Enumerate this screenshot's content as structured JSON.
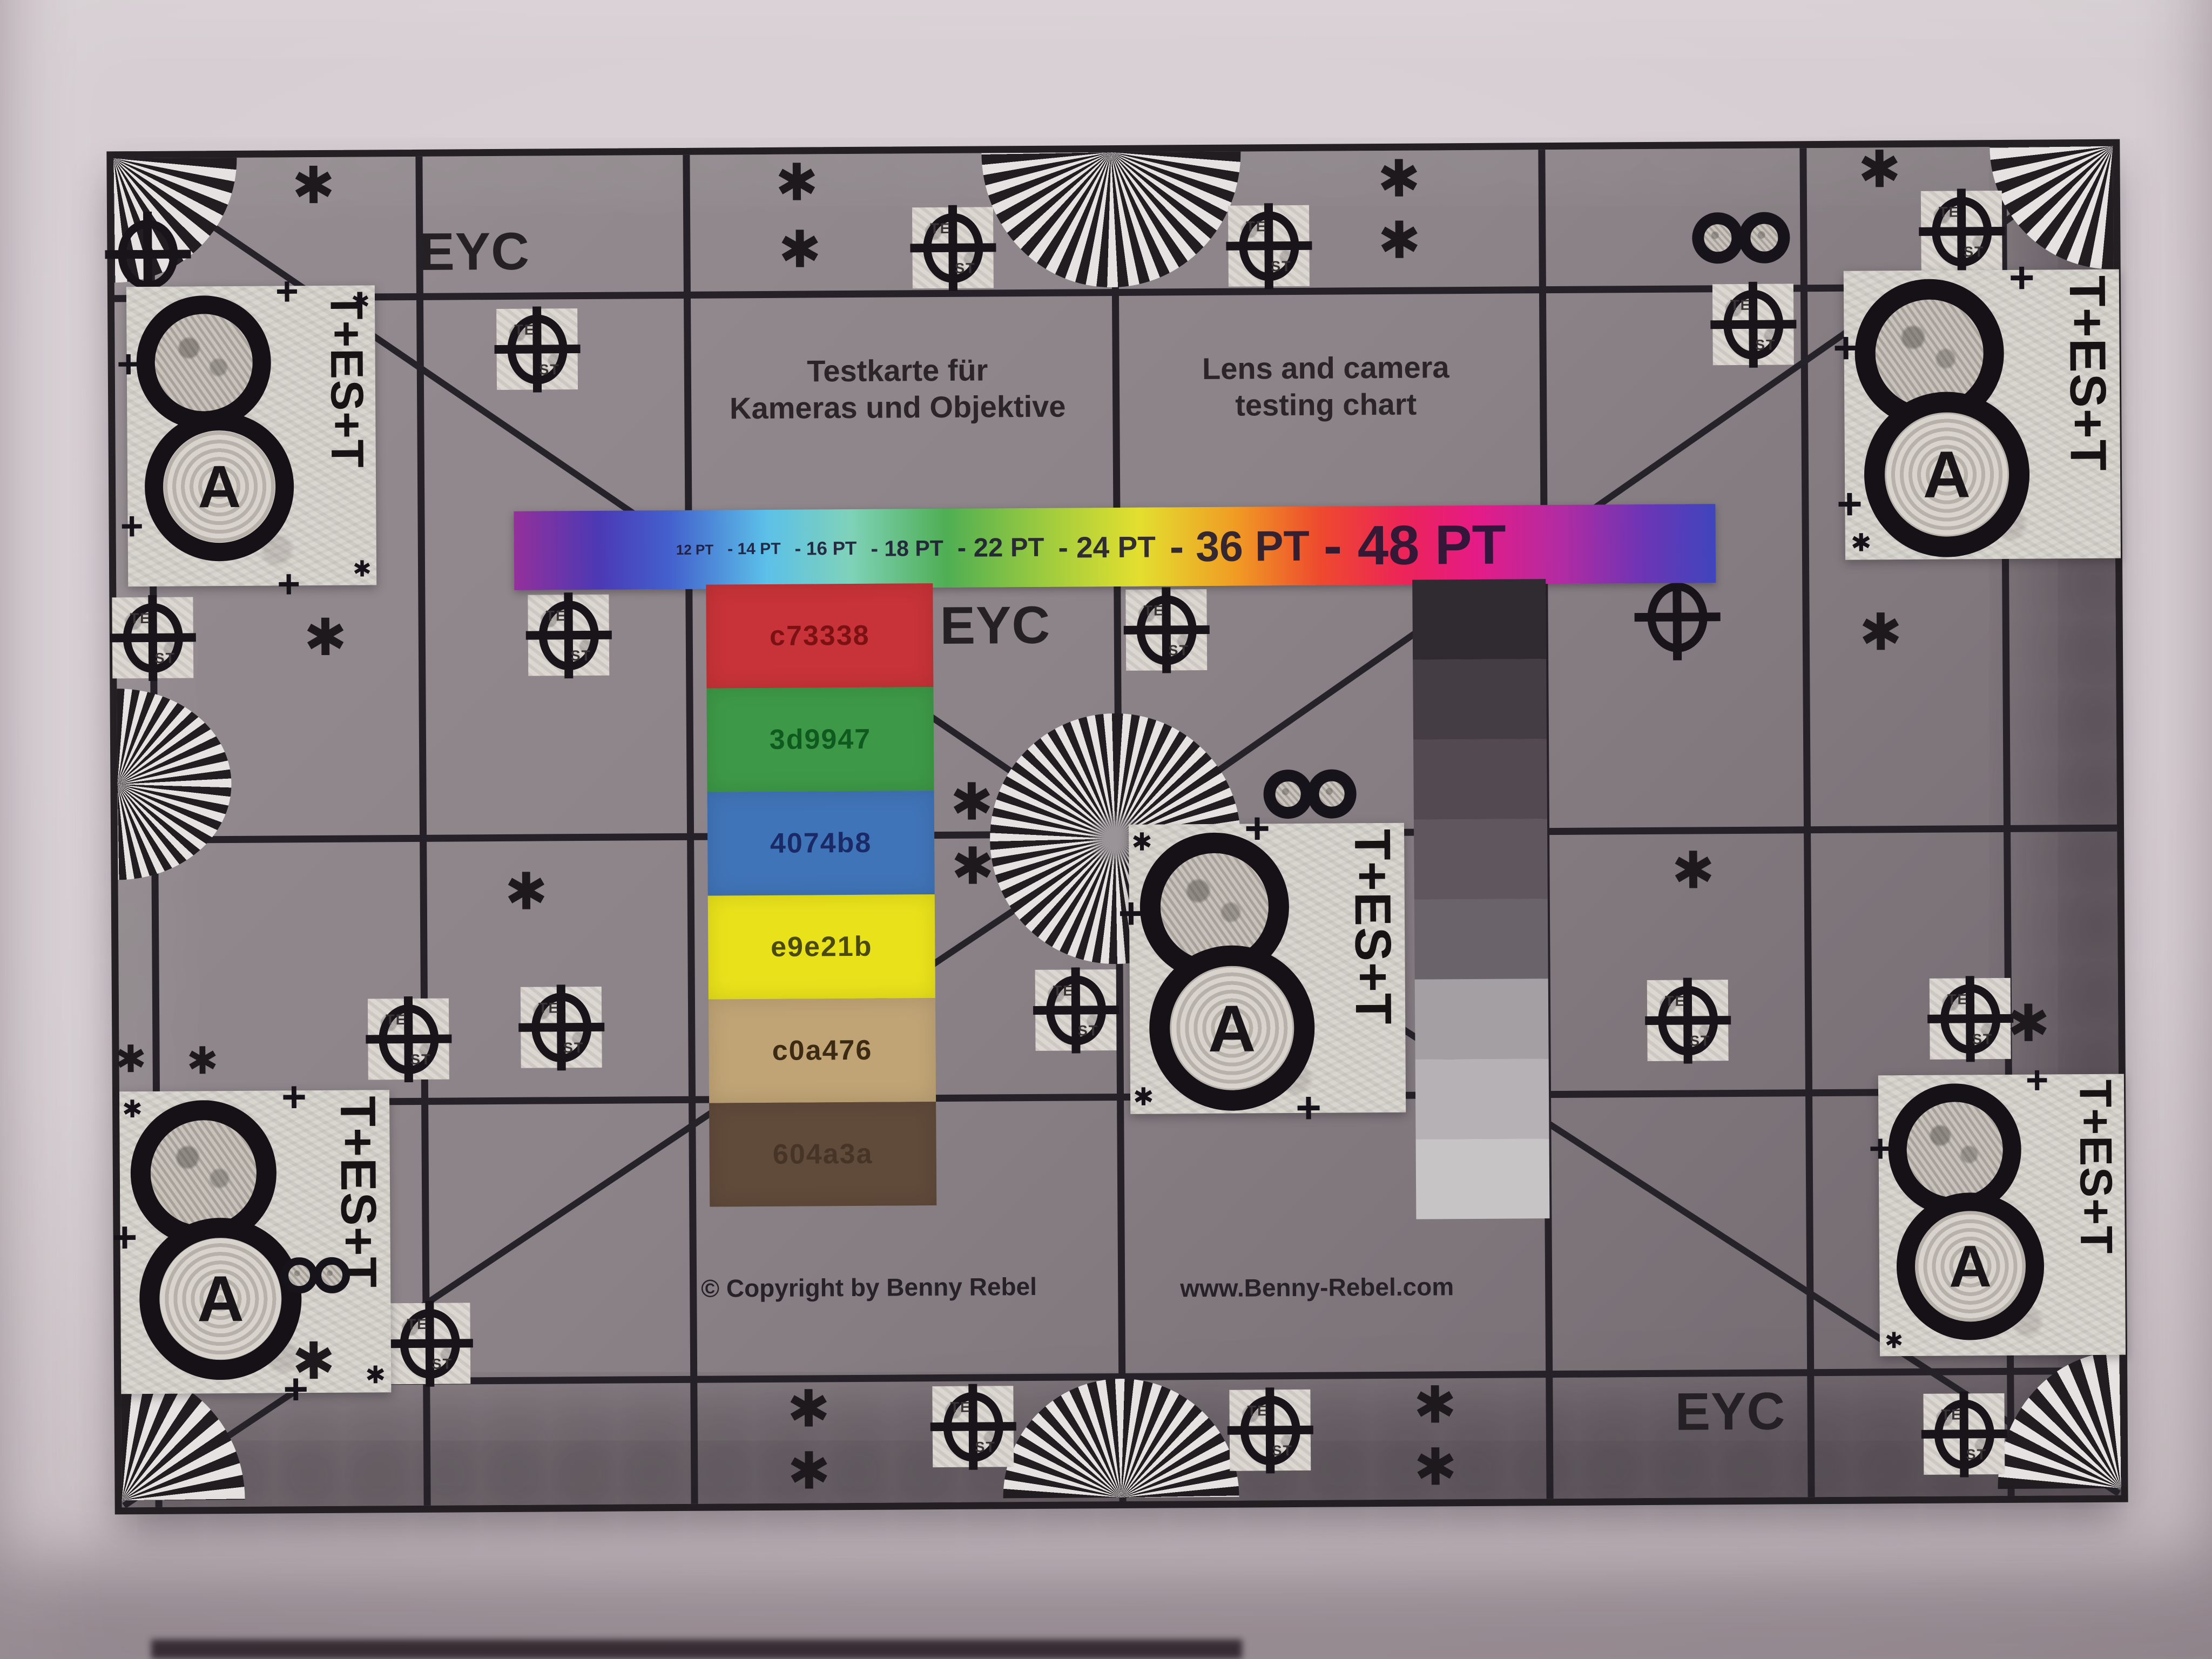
{
  "chart": {
    "eyc": "EYC",
    "titles": {
      "de": [
        "Testkarte für",
        "Kameras und Objektive"
      ],
      "en": [
        "Lens and camera",
        "testing chart"
      ]
    },
    "footer": {
      "copyright": "© Copyright by Benny Rebel",
      "website": "www.Benny-Rebel.com"
    },
    "rainbow_bar": {
      "pt_labels": [
        "12 PT",
        "- 14 PT",
        "- 16 PT",
        "- 18 PT",
        "- 22 PT",
        "- 24 PT",
        "- 36 PT",
        "- 48 PT"
      ],
      "gradient": [
        "#94309b",
        "#4c39b4",
        "#4361cd",
        "#5cc0e8",
        "#7fd2b9",
        "#4fae53",
        "#9ccb3f",
        "#e3df2f",
        "#f09c24",
        "#ee4a2e",
        "#ec2458",
        "#e51b86",
        "#b32ba2",
        "#6c35b5",
        "#3f45bd"
      ]
    },
    "color_patches": [
      {
        "hex": "c73338",
        "color": "#c73338",
        "label_color": "#7c1113"
      },
      {
        "hex": "3d9947",
        "color": "#3d9947",
        "label_color": "#0f5a1e"
      },
      {
        "hex": "4074b8",
        "color": "#4074b8",
        "label_color": "#1a2a66"
      },
      {
        "hex": "e9e21b",
        "color": "#e9e21b",
        "label_color": "#4a4a10"
      },
      {
        "hex": "c0a476",
        "color": "#c0a476",
        "label_color": "#3c2a12"
      },
      {
        "hex": "604a3a",
        "color": "#604a3a",
        "label_color": "#463527"
      }
    ],
    "grayscale_steps": [
      "#2f2b31",
      "#443d43",
      "#524a50",
      "#5f575d",
      "#6b636a",
      "#a49fa3",
      "#b5b1b4",
      "#c7c4c5"
    ],
    "targets": {
      "vertical_test": "T+ES+T",
      "letter_a": "A",
      "figure_eight": "8",
      "te": "TE",
      "st": "ST",
      "asterisk": "✱",
      "plus": "+"
    }
  }
}
